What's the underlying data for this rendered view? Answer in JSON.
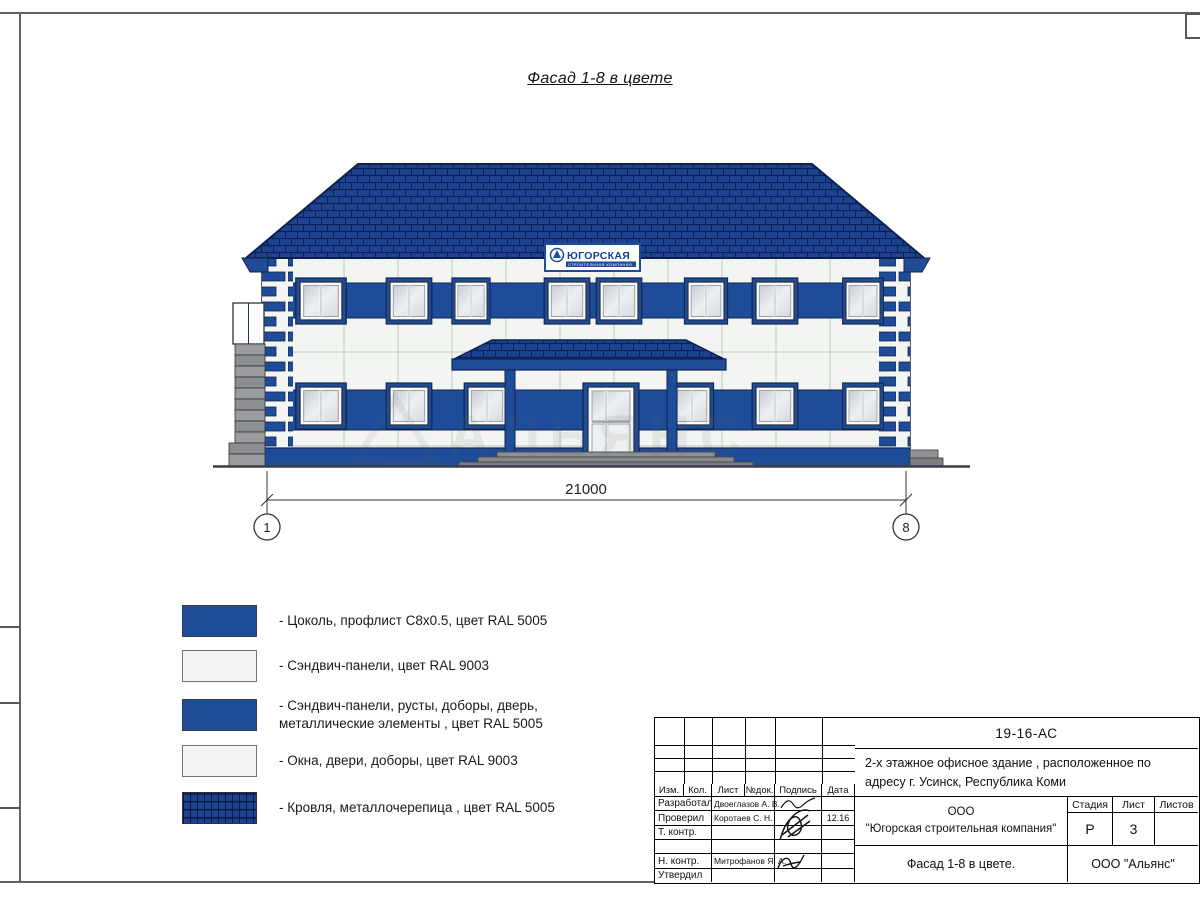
{
  "page": {
    "title": "Фасад 1-8 в цвете"
  },
  "facade": {
    "sign": {
      "name": "ЮГОРСКАЯ",
      "subtitle": "СТРОИТЕЛЬНАЯ КОМПАНИЯ"
    },
    "dimension": {
      "width": "21000",
      "axis_start": "1",
      "axis_end": "8"
    },
    "watermark": "АЛЬЯНС"
  },
  "legend": {
    "items": [
      {
        "swatch": "blue",
        "label": "- Цоколь, профлист С8х0.5, цвет RAL 5005"
      },
      {
        "swatch": "white",
        "label": "- Сэндвич-панели, цвет RAL 9003"
      },
      {
        "swatch": "blue",
        "label": "- Сэндвич-панели, русты, доборы, дверь,\nметаллические элементы , цвет RAL 5005"
      },
      {
        "swatch": "white",
        "label": "- Окна, двери, доборы, цвет RAL 9003"
      },
      {
        "swatch": "roof",
        "label": "- Кровля, металлочерепица , цвет RAL 5005"
      }
    ]
  },
  "title_block": {
    "doc_number": "19-16-АС",
    "project_description": "2-х этажное офисное здание , расположенное по адресу г. Усинск, Республика Коми",
    "columns": [
      "Изм.",
      "Кол.",
      "Лист",
      "№док.",
      "Подпись",
      "Дата"
    ],
    "rows": [
      {
        "role": "Разработал",
        "name": "Двоеглазов А. В.",
        "date": ""
      },
      {
        "role": "Проверил",
        "name": "Коротаев С. Н.",
        "date": "12.16"
      },
      {
        "role": "Т. контр.",
        "name": "",
        "date": ""
      },
      {
        "role": "",
        "name": "",
        "date": ""
      },
      {
        "role": "Н. контр.",
        "name": "Митрофанов Я. А.",
        "date": ""
      },
      {
        "role": "Утвердил",
        "name": "",
        "date": ""
      }
    ],
    "company_line1": "ООО",
    "company_line2": "\"Югорская строительная компания\"",
    "stage_label": "Стадия",
    "sheet_label": "Лист",
    "sheets_label": "Листов",
    "stage_value": "Р",
    "sheet_value": "3",
    "sheets_value": "",
    "drawing_name": "Фасад 1-8 в цвете.",
    "org": "ООО \"Альянс\""
  },
  "colors": {
    "ral5005": "#1E4C99",
    "ral9003": "#F2F5F1",
    "roof_blue": "#1B4390"
  }
}
